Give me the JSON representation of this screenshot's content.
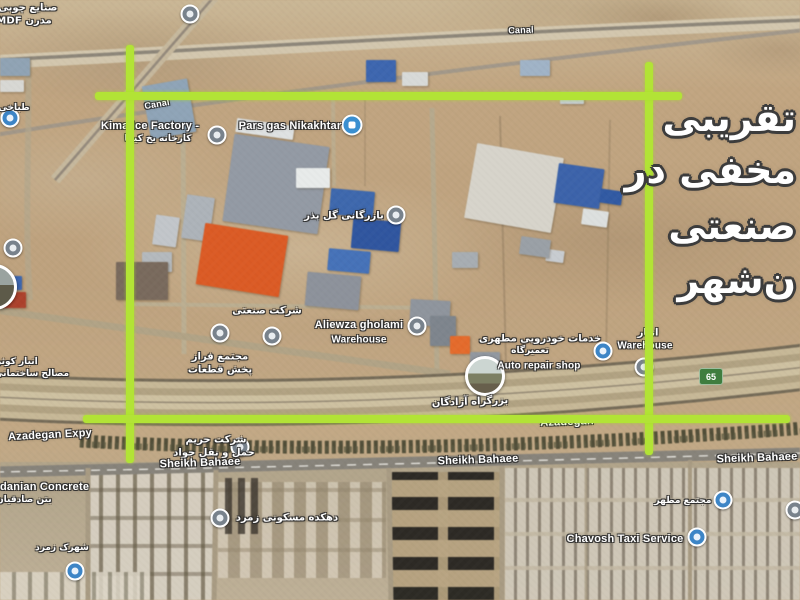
{
  "overlay_text": {
    "color": "#ffffff",
    "lines": [
      {
        "text": "تقریبی",
        "top": 96
      },
      {
        "text": "مخفی در",
        "top": 148
      },
      {
        "text": "صنعتی",
        "top": 204
      },
      {
        "text": "ن‌شهر",
        "top": 258
      }
    ]
  },
  "route_shield": {
    "label": "65"
  },
  "annotation": {
    "color": "#b2e336",
    "lines": [
      {
        "name": "left-vertical-line",
        "x": 126,
        "y": 45,
        "w": 8,
        "h": 418
      },
      {
        "name": "right-vertical-line",
        "x": 645,
        "y": 62,
        "w": 8,
        "h": 393
      },
      {
        "name": "top-horizontal-line",
        "x": 95,
        "y": 92,
        "w": 587,
        "h": 8
      },
      {
        "name": "bottom-horizontal-line",
        "x": 83,
        "y": 415,
        "w": 707,
        "h": 8
      }
    ]
  },
  "labels": [
    {
      "t": "صنایع چوبی",
      "x": 28,
      "y": 8,
      "fs": 10,
      "rtl": true
    },
    {
      "t": "مدرن MDF",
      "x": 24,
      "y": 21,
      "fs": 10,
      "rtl": true
    },
    {
      "t": "طباخی",
      "x": 14,
      "y": 108,
      "fs": 9,
      "rtl": true
    },
    {
      "t": "Canal",
      "x": 157,
      "y": 104,
      "fs": 9,
      "rot": -10
    },
    {
      "t": "Canal",
      "x": 521,
      "y": 30,
      "fs": 9,
      "rot": -2
    },
    {
      "t": "Kima Ice Factory -",
      "x": 150,
      "y": 126,
      "fs": 11
    },
    {
      "t": "کارخانه یخ کیما",
      "x": 158,
      "y": 139,
      "fs": 9,
      "rtl": true
    },
    {
      "t": "Pars gas Nikakhtar",
      "x": 290,
      "y": 126,
      "fs": 11
    },
    {
      "t": "بازرگانی گل بذر",
      "x": 344,
      "y": 216,
      "fs": 10,
      "rtl": true
    },
    {
      "t": "شرکت صنعتی",
      "x": 267,
      "y": 311,
      "fs": 10,
      "rtl": true
    },
    {
      "t": "مجتمع فراز",
      "x": 220,
      "y": 357,
      "fs": 10,
      "rtl": true
    },
    {
      "t": "پخش قطعات",
      "x": 220,
      "y": 370,
      "fs": 10,
      "rtl": true
    },
    {
      "t": "Aliewza gholami",
      "x": 359,
      "y": 325,
      "fs": 11
    },
    {
      "t": "Warehouse",
      "x": 359,
      "y": 340,
      "fs": 10
    },
    {
      "t": "خدمات خودرویی مطهری",
      "x": 540,
      "y": 339,
      "fs": 10,
      "rtl": true
    },
    {
      "t": "تعمیرگاه",
      "x": 530,
      "y": 351,
      "fs": 9,
      "rtl": true
    },
    {
      "t": "Auto repair shop",
      "x": 539,
      "y": 366,
      "fs": 10
    },
    {
      "t": "انبار",
      "x": 648,
      "y": 333,
      "fs": 10,
      "rtl": true
    },
    {
      "t": "Warehouse",
      "x": 645,
      "y": 346,
      "fs": 10
    },
    {
      "t": "بزرگراه آزادگان",
      "x": 470,
      "y": 402,
      "fs": 10,
      "rtl": true,
      "rot": -2
    },
    {
      "t": "Azadegan",
      "x": 567,
      "y": 422,
      "fs": 11,
      "rot": -2
    },
    {
      "t": "Azadegan Expy",
      "x": 50,
      "y": 435,
      "fs": 11,
      "rot": -3
    },
    {
      "t": "شرکت حریم",
      "x": 216,
      "y": 440,
      "fs": 10,
      "rtl": true
    },
    {
      "t": "حمل و نقل جواد",
      "x": 214,
      "y": 453,
      "fs": 10,
      "rtl": true
    },
    {
      "t": "Sheikh Bahaee",
      "x": 200,
      "y": 463,
      "fs": 11,
      "rot": -2
    },
    {
      "t": "Sheikh Bahaee",
      "x": 478,
      "y": 460,
      "fs": 11,
      "rot": -2
    },
    {
      "t": "Sheikh Bahaee",
      "x": 757,
      "y": 458,
      "fs": 11,
      "rot": -2
    },
    {
      "t": "danian Concrete",
      "x": 0,
      "y": 487,
      "fs": 11,
      "anchor": "l"
    },
    {
      "t": "بتن صادقیان",
      "x": -4,
      "y": 500,
      "fs": 9,
      "rtl": true,
      "anchor": "l"
    },
    {
      "t": "انبار کوثر",
      "x": -4,
      "y": 362,
      "fs": 9,
      "rtl": true,
      "anchor": "l"
    },
    {
      "t": "مصالح ساختمانی",
      "x": -6,
      "y": 374,
      "fs": 9,
      "rtl": true,
      "anchor": "l"
    },
    {
      "t": "دهکده مسکونی زمرد",
      "x": 287,
      "y": 518,
      "fs": 10,
      "rtl": true
    },
    {
      "t": "مجتمع مطهر",
      "x": 683,
      "y": 501,
      "fs": 9,
      "rtl": true
    },
    {
      "t": "Chavosh Taxi Service",
      "x": 625,
      "y": 539,
      "fs": 11
    },
    {
      "t": "شهرک زمرد",
      "x": 62,
      "y": 548,
      "fs": 9,
      "rtl": true
    }
  ],
  "pins": [
    {
      "type": "gray",
      "x": 190,
      "y": 14
    },
    {
      "type": "blue",
      "x": 10,
      "y": 118
    },
    {
      "type": "gray",
      "x": 217,
      "y": 135
    },
    {
      "type": "gas",
      "x": 352,
      "y": 125
    },
    {
      "type": "gray",
      "x": 396,
      "y": 215
    },
    {
      "type": "gray",
      "x": 13,
      "y": 248
    },
    {
      "type": "photohalf",
      "x": -6,
      "y": 287
    },
    {
      "type": "gray",
      "x": 220,
      "y": 333
    },
    {
      "type": "gray",
      "x": 272,
      "y": 336
    },
    {
      "type": "gray",
      "x": 417,
      "y": 326
    },
    {
      "type": "photo",
      "x": 485,
      "y": 376
    },
    {
      "type": "blue",
      "x": 603,
      "y": 351
    },
    {
      "type": "gray",
      "x": 644,
      "y": 367
    },
    {
      "type": "gray",
      "x": 240,
      "y": 447
    },
    {
      "type": "gray",
      "x": 220,
      "y": 518
    },
    {
      "type": "blue",
      "x": 697,
      "y": 537
    },
    {
      "type": "blue",
      "x": 723,
      "y": 500
    },
    {
      "type": "gray",
      "x": 795,
      "y": 510
    },
    {
      "type": "blue",
      "x": 75,
      "y": 571
    }
  ],
  "buildings": [
    {
      "x": 146,
      "y": 82,
      "w": 46,
      "h": 54,
      "c": "#8ea4b8",
      "r": -10
    },
    {
      "x": 228,
      "y": 140,
      "w": 96,
      "h": 88,
      "c": "#939aa4",
      "r": 8
    },
    {
      "x": 236,
      "y": 122,
      "w": 58,
      "h": 14,
      "c": "#dfe2e2",
      "r": 8
    },
    {
      "x": 184,
      "y": 196,
      "w": 28,
      "h": 44,
      "c": "#adb3b9",
      "r": 8
    },
    {
      "x": 154,
      "y": 216,
      "w": 24,
      "h": 30,
      "c": "#c2c6ca",
      "r": 8
    },
    {
      "x": 142,
      "y": 252,
      "w": 30,
      "h": 20,
      "c": "#b4b9bd",
      "r": 0
    },
    {
      "x": 200,
      "y": 229,
      "w": 84,
      "h": 62,
      "c": "#df5a22",
      "r": 9
    },
    {
      "x": 296,
      "y": 168,
      "w": 34,
      "h": 20,
      "c": "#e8ebea",
      "r": 0
    },
    {
      "x": 330,
      "y": 190,
      "w": 44,
      "h": 26,
      "c": "#3c68b0",
      "r": 5
    },
    {
      "x": 352,
      "y": 220,
      "w": 48,
      "h": 30,
      "c": "#2f56a2",
      "r": 5
    },
    {
      "x": 328,
      "y": 250,
      "w": 42,
      "h": 22,
      "c": "#4472bb",
      "r": 5
    },
    {
      "x": 306,
      "y": 274,
      "w": 54,
      "h": 34,
      "c": "#8d929b",
      "r": 5
    },
    {
      "x": 366,
      "y": 60,
      "w": 30,
      "h": 22,
      "c": "#3b66b2",
      "r": 0
    },
    {
      "x": 402,
      "y": 72,
      "w": 26,
      "h": 14,
      "c": "#d8dad8",
      "r": 0
    },
    {
      "x": 470,
      "y": 150,
      "w": 88,
      "h": 76,
      "c": "#d7d4cb",
      "r": 10
    },
    {
      "x": 556,
      "y": 166,
      "w": 46,
      "h": 40,
      "c": "#3a63ad",
      "r": 8
    },
    {
      "x": 600,
      "y": 190,
      "w": 22,
      "h": 14,
      "c": "#2f5aa6",
      "r": 8
    },
    {
      "x": 582,
      "y": 210,
      "w": 26,
      "h": 16,
      "c": "#dde0df",
      "r": 8
    },
    {
      "x": 546,
      "y": 250,
      "w": 18,
      "h": 12,
      "c": "#c8ccd0",
      "r": 8
    },
    {
      "x": 520,
      "y": 238,
      "w": 30,
      "h": 18,
      "c": "#9aa0a6",
      "r": 8
    },
    {
      "x": 452,
      "y": 252,
      "w": 26,
      "h": 16,
      "c": "#a7adb2",
      "r": 0
    },
    {
      "x": 410,
      "y": 300,
      "w": 40,
      "h": 26,
      "c": "#8f959d",
      "r": 3
    },
    {
      "x": 430,
      "y": 316,
      "w": 26,
      "h": 30,
      "c": "#7e858d",
      "r": 0
    },
    {
      "x": 450,
      "y": 336,
      "w": 20,
      "h": 18,
      "c": "#e86a28",
      "r": 0
    },
    {
      "x": 470,
      "y": 352,
      "w": 30,
      "h": 16,
      "c": "#9298a0",
      "r": 0
    },
    {
      "x": 116,
      "y": 262,
      "w": 52,
      "h": 38,
      "c": "#7a6a5c",
      "r": 0
    },
    {
      "x": 0,
      "y": 276,
      "w": 22,
      "h": 14,
      "c": "#3b66b2",
      "r": 0
    },
    {
      "x": 0,
      "y": 292,
      "w": 26,
      "h": 16,
      "c": "#b0402a",
      "r": 0
    },
    {
      "x": 0,
      "y": 58,
      "w": 30,
      "h": 18,
      "c": "#8fa3b5",
      "r": 0
    },
    {
      "x": 0,
      "y": 80,
      "w": 24,
      "h": 12,
      "c": "#d8d8d4",
      "r": 0
    },
    {
      "x": 520,
      "y": 60,
      "w": 30,
      "h": 16,
      "c": "#9fb3c8",
      "r": 0
    },
    {
      "x": 560,
      "y": 92,
      "w": 24,
      "h": 12,
      "c": "#c5ccd2",
      "r": 0
    }
  ]
}
